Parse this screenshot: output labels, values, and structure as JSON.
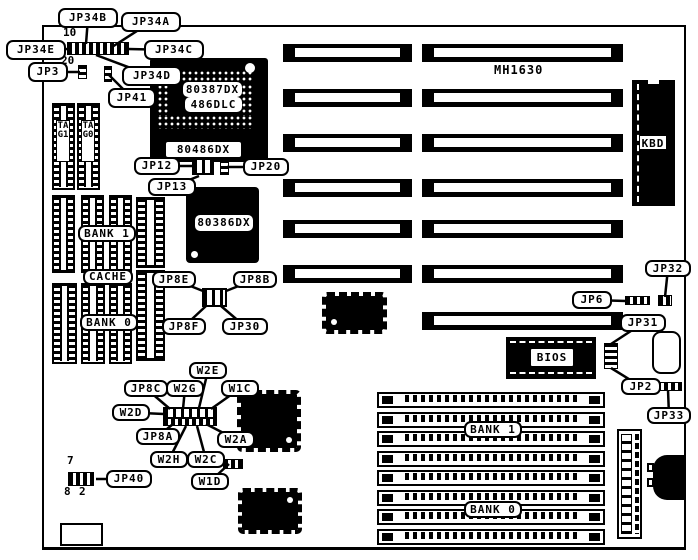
{
  "board_model": "MH1630",
  "chips": {
    "cpu_socket_line1": "80387DX",
    "cpu_socket_line2": "486DLC",
    "cpu_socket_bottom": "80486DX",
    "cpu386": "80386DX",
    "bios": "BIOS",
    "kbd": "KBD"
  },
  "memory_labels": {
    "tag1": "TAG1",
    "tag0": "TAG0",
    "dip_bank1": "BANK 1",
    "cache": "CACHE",
    "dip_bank0": "BANK 0",
    "simm_bank1": "BANK 1",
    "simm_bank0": "BANK 0"
  },
  "pin_numbers": {
    "jp34_top": "10",
    "jp34_bottom": "20",
    "jp40_top": "7",
    "jp40_bottom_left": "8",
    "jp40_bottom_right": "2"
  },
  "callouts": [
    {
      "id": "jp34b",
      "label": "JP34B"
    },
    {
      "id": "jp34a",
      "label": "JP34A"
    },
    {
      "id": "jp34e",
      "label": "JP34E"
    },
    {
      "id": "jp34c",
      "label": "JP34C"
    },
    {
      "id": "jp34d",
      "label": "JP34D"
    },
    {
      "id": "jp3",
      "label": "JP3"
    },
    {
      "id": "jp41",
      "label": "JP41"
    },
    {
      "id": "jp12",
      "label": "JP12"
    },
    {
      "id": "jp20",
      "label": "JP20"
    },
    {
      "id": "jp13",
      "label": "JP13"
    },
    {
      "id": "jp8e",
      "label": "JP8E"
    },
    {
      "id": "jp8b",
      "label": "JP8B"
    },
    {
      "id": "jp8f",
      "label": "JP8F"
    },
    {
      "id": "jp30",
      "label": "JP30"
    },
    {
      "id": "jp8c",
      "label": "JP8C"
    },
    {
      "id": "w2g",
      "label": "W2G"
    },
    {
      "id": "w2e",
      "label": "W2E"
    },
    {
      "id": "w1c",
      "label": "W1C"
    },
    {
      "id": "w2d",
      "label": "W2D"
    },
    {
      "id": "jp8a",
      "label": "JP8A"
    },
    {
      "id": "w2a",
      "label": "W2A"
    },
    {
      "id": "w2h",
      "label": "W2H"
    },
    {
      "id": "w2c",
      "label": "W2C"
    },
    {
      "id": "w1d",
      "label": "W1D"
    },
    {
      "id": "jp40",
      "label": "JP40"
    },
    {
      "id": "jp32",
      "label": "JP32"
    },
    {
      "id": "jp6",
      "label": "JP6"
    },
    {
      "id": "jp31",
      "label": "JP31"
    },
    {
      "id": "jp2",
      "label": "JP2"
    },
    {
      "id": "jp33",
      "label": "JP33"
    }
  ],
  "colors": {
    "ink": "#000000",
    "paper": "#ffffff"
  }
}
